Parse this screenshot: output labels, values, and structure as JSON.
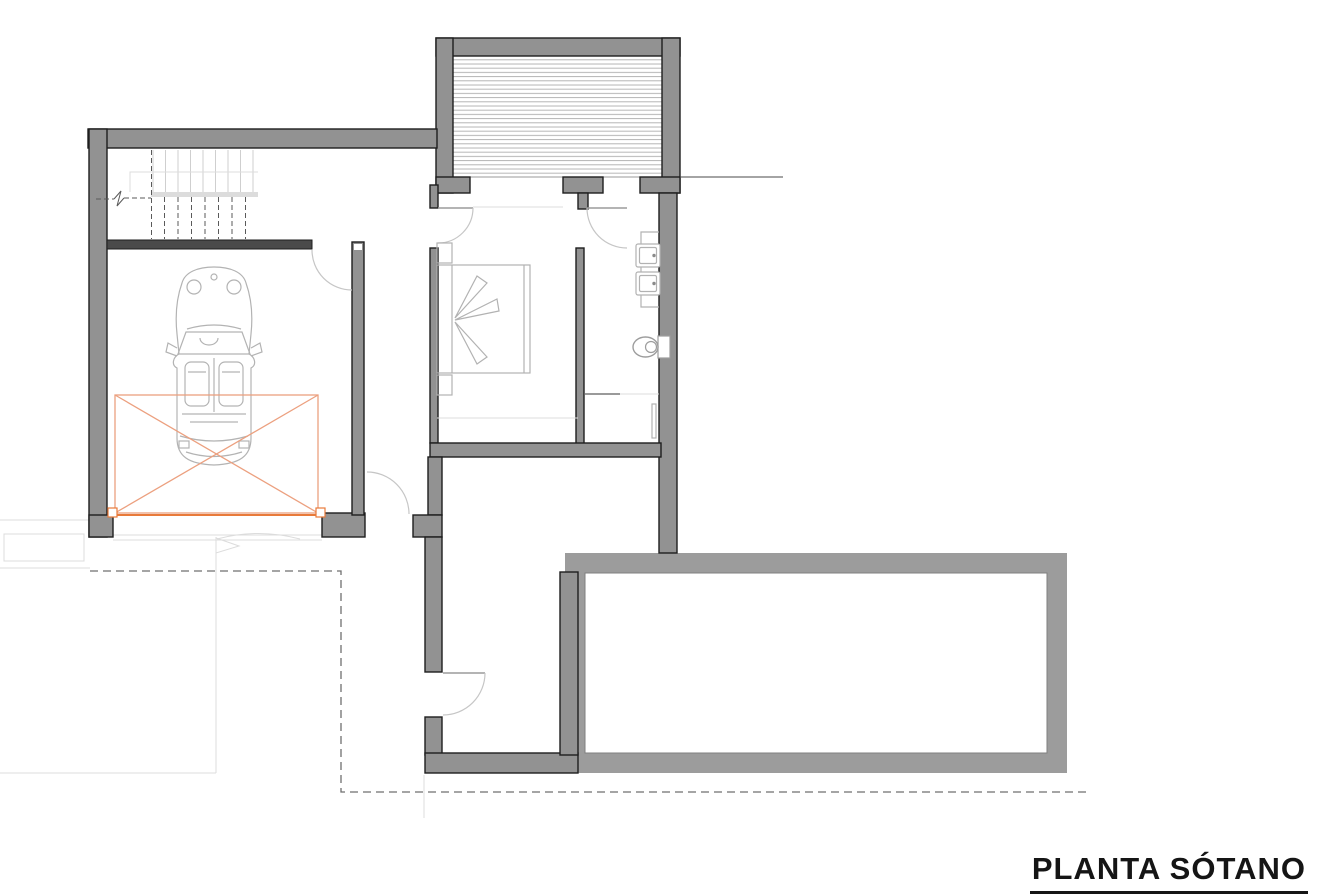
{
  "title_block": {
    "text": "PLANTA SÓTANO"
  },
  "colors": {
    "wall_fill": "#929292",
    "wall_stroke": "#1e1e1e",
    "dark_wall": "#4a4a4a",
    "pool_fill": "#9c9c9c",
    "pool_inner": "#7f7f7f",
    "door_arc": "#c6c6c6",
    "fixture_stroke": "#b2b2b2",
    "faint_line": "#dcdcdc",
    "hatch_line": "#b5b5b5",
    "dashed_line": "#6f6f6f",
    "car_stroke": "#b3b3b3",
    "platform_orange": "#e87a3a",
    "platform_orange_light": "#eca07f",
    "title_color": "#151515"
  }
}
